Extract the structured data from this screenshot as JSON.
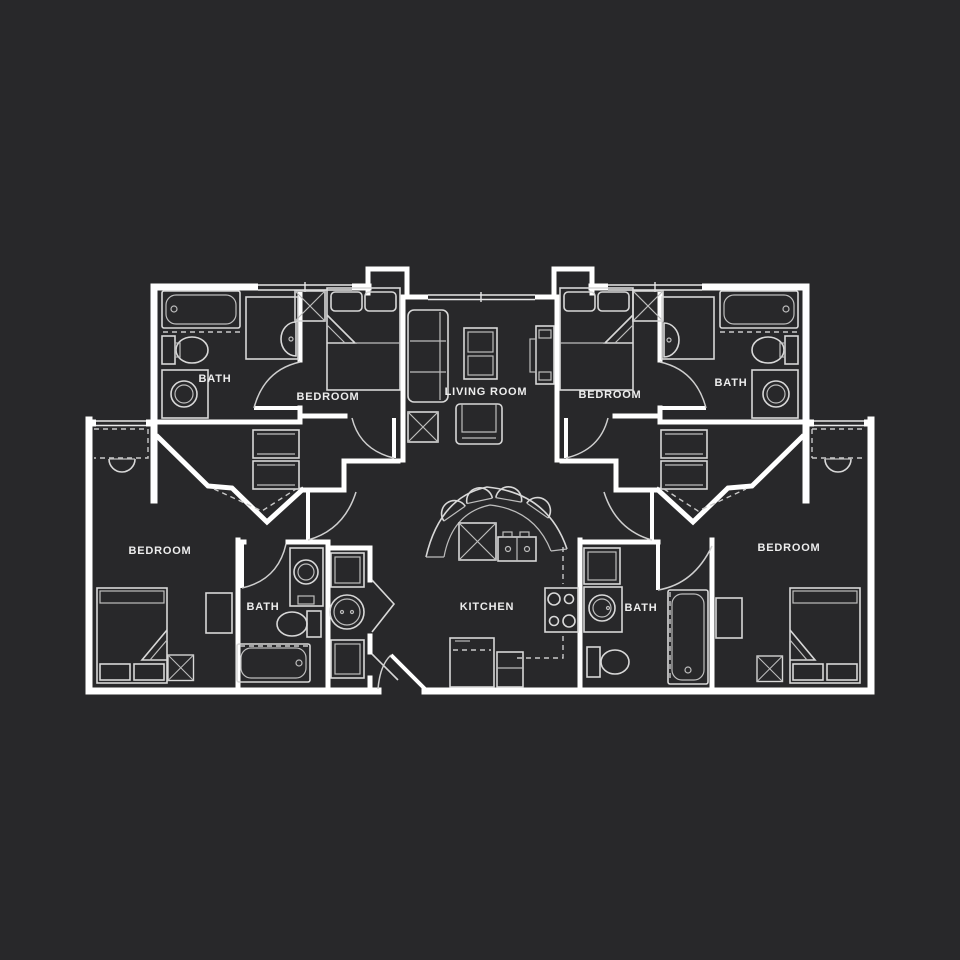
{
  "canvas": {
    "background_color": "#28282a",
    "wall_color": "#ffffff",
    "furniture_line_color": "#d8d8d8",
    "label_color": "#ededed"
  },
  "floor_plan": {
    "rooms": [
      {
        "id": "bath-upper-left",
        "label": "BATH"
      },
      {
        "id": "bedroom-upper-left",
        "label": "BEDROOM"
      },
      {
        "id": "living-room",
        "label": "LIVING ROOM"
      },
      {
        "id": "bedroom-upper-right",
        "label": "BEDROOM"
      },
      {
        "id": "bath-upper-right",
        "label": "BATH"
      },
      {
        "id": "bedroom-lower-left",
        "label": "BEDROOM"
      },
      {
        "id": "bath-lower-left",
        "label": "BATH"
      },
      {
        "id": "kitchen",
        "label": "KITCHEN"
      },
      {
        "id": "bath-lower-right",
        "label": "BATH"
      },
      {
        "id": "bedroom-lower-right",
        "label": "BEDROOM"
      }
    ]
  }
}
